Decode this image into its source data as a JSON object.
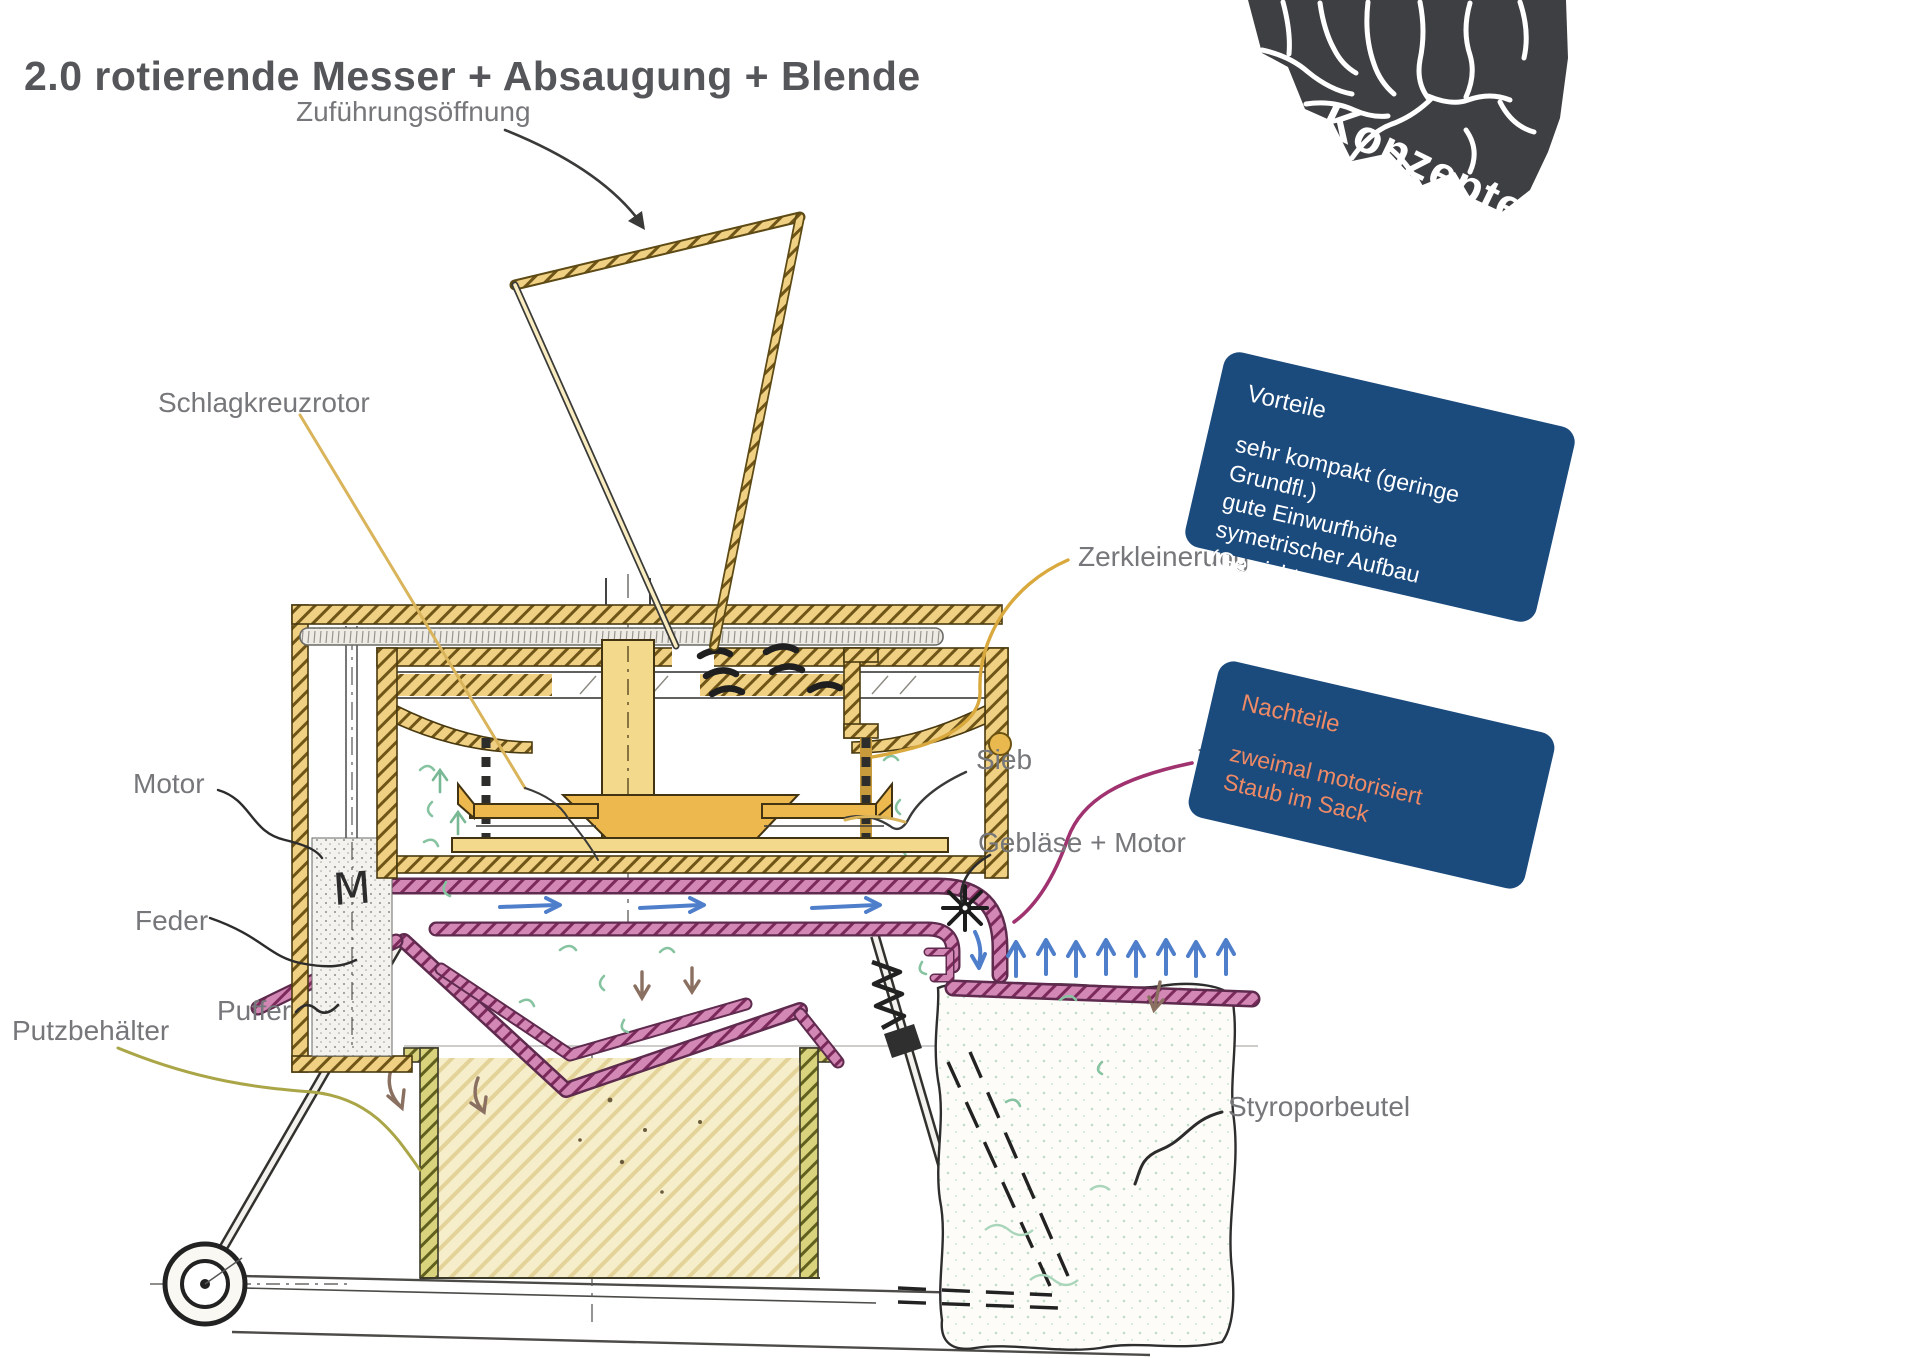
{
  "title": "2.0 rotierende Messer + Absaugung + Blende",
  "logo": {
    "text": "Konzepte"
  },
  "diagram_labels": {
    "zufuehrungsoeffnung": "Zuführungsöffnung",
    "schlagkreuzrotor": "Schlagkreuzrotor",
    "zerkleinerung": "Zerkleinerung",
    "sieb": "Sieb",
    "trennung": "Trennung",
    "geblaese_motor": "Gebläse + Motor",
    "motor": "Motor",
    "motor_symbol": "M",
    "feder": "Feder",
    "puffer": "Puffer",
    "putzbehaelter": "Putzbehälter",
    "styroporbeutel": "Styroporbeutel"
  },
  "advantages_box": {
    "heading": "Vorteile",
    "lines": [
      "sehr kompakt (geringe Grundfl.)",
      "gute Einwurfhöhe",
      "symetrischer Aufbau (Gewichtsver-",
      "teilung)"
    ]
  },
  "disadvantages_box": {
    "heading": "Nachteile",
    "lines": [
      "zweimal motorisiert",
      "Staub im Sack"
    ]
  },
  "colors": {
    "accent_blue": "#1b4a7d",
    "disadvantage_text": "#ee8a65",
    "sketch_yellow": "#e9bb55",
    "sketch_pink": "#c45a94",
    "sketch_olive": "#b9b44a",
    "label_gray": "#76777a",
    "stone_dark": "#3e3f42"
  }
}
